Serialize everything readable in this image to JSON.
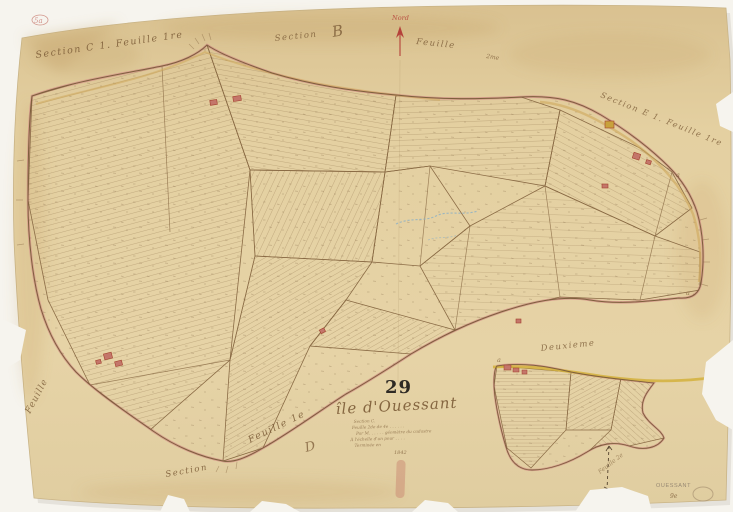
{
  "sheet": {
    "corner_mark": "5a",
    "neighbor_labels": {
      "top_left": "Section C 1.  Feuille 1re",
      "top_center_section": "Section",
      "top_center_letter": "B",
      "north": "Nord",
      "top_center_feuille": "Feuille",
      "top_center_suffix": "2me",
      "top_right": "Section E 1. Feuille 1re",
      "left_edge": "Feuille",
      "bottom_feuille": "Feuille 1e",
      "bottom_section": "Section",
      "bottom_letter": "D",
      "inset_title": "Deuxieme",
      "inset_feuille": "Feuille 2e"
    },
    "title_block": {
      "number": "29",
      "title": "île d'Ouessant",
      "line1": "Section C.",
      "line2": "Feuille 2de de 4e . . . . . .",
      "line3": "Par M. . . . . . géomètre du cadastre",
      "line4": "À l'échelle d'un pour . . . .",
      "line5": "Terminée en",
      "year": "1842"
    },
    "stamp": {
      "name": "OUESSANT",
      "number": "9e"
    },
    "marker_a": "a"
  }
}
